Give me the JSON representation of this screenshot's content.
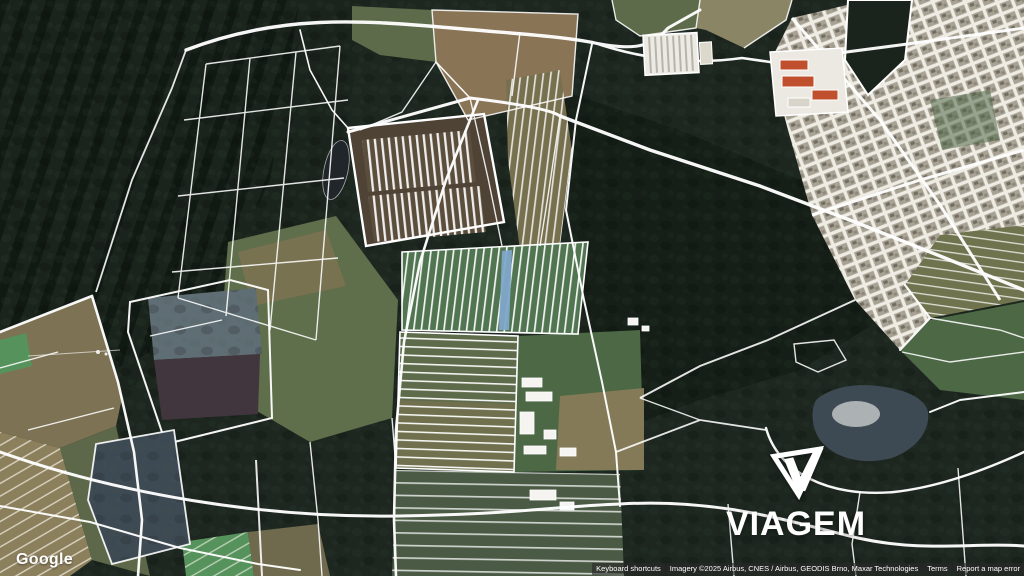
{
  "map": {
    "provider_logo": "Google",
    "watermark": {
      "brand": "VIAGEM"
    },
    "attribution": {
      "keyboard_shortcuts": "Keyboard shortcuts",
      "imagery_credit": "Imagery ©2025 Airbus, CNES / Airbus, GEODIS Brno, Maxar Technologies",
      "terms": "Terms",
      "report_error": "Report a map error"
    },
    "icons": {
      "viagem_logo": "inverted-triangle-with-v"
    },
    "colors": {
      "forest_base": "#1d2720",
      "forest_dark": "#151e17",
      "field_tan": "#8a7456",
      "field_olive": "#5f6e4b",
      "field_green": "#4c6845",
      "field_bright_green": "#55925c",
      "marsh_blue": "#5f6d74",
      "pond_dark": "#42363e",
      "water_gray": "#3e4a53",
      "town_light": "#a8a294",
      "roof_red": "#c0502d",
      "boundary_white": "#ffffff",
      "crop_strip_blue": "#7fa6c9"
    }
  }
}
